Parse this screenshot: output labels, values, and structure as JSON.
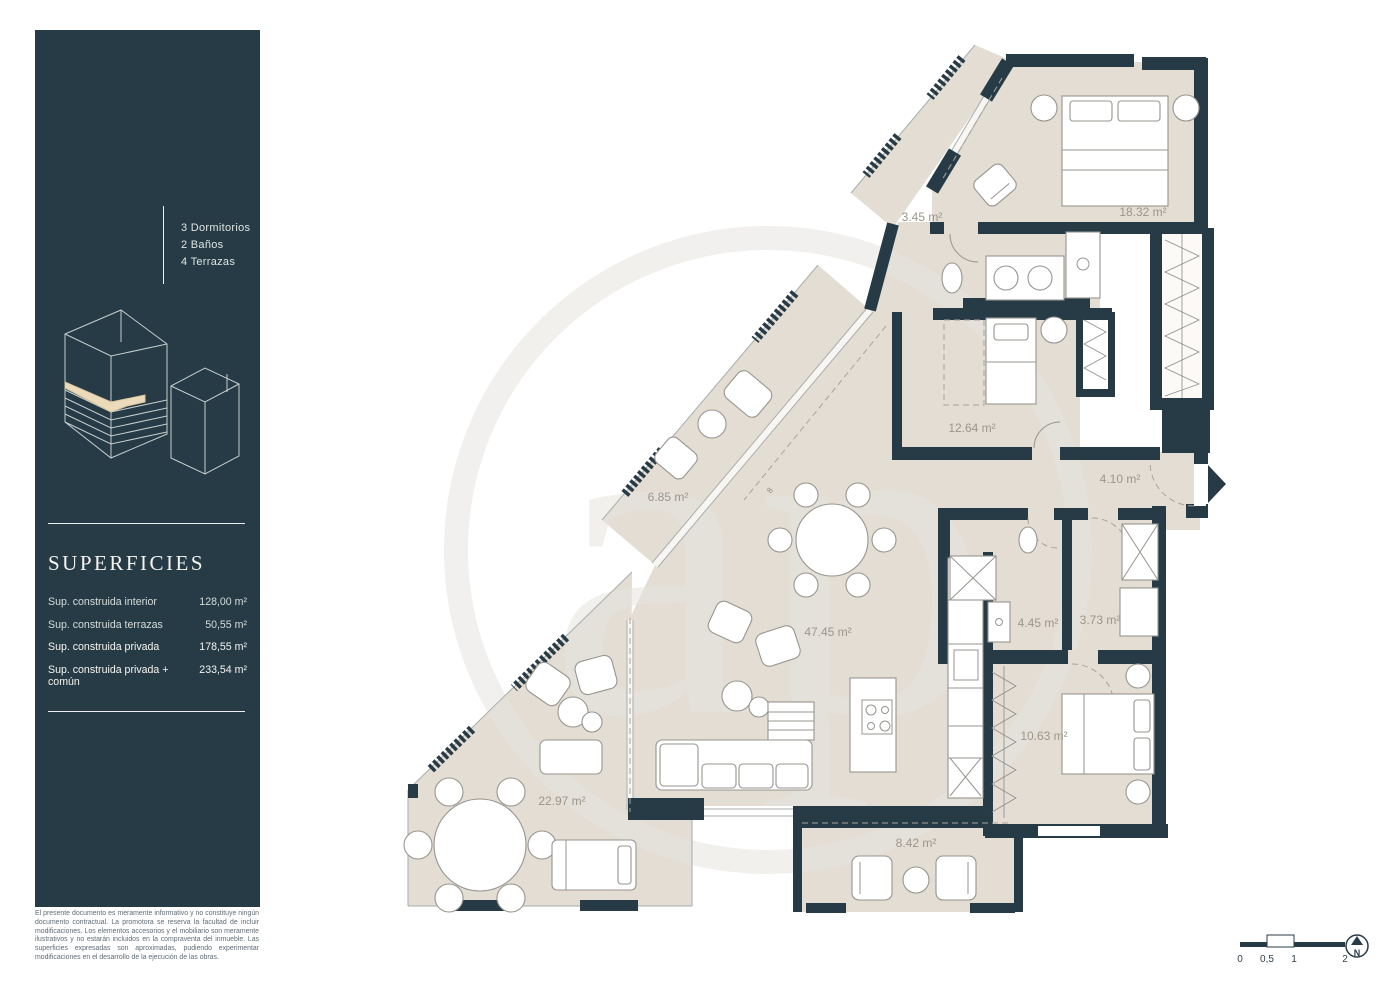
{
  "sidebar": {
    "program": [
      "3 Dormitorios",
      "2 Baños",
      "4 Terrazas"
    ],
    "superficies_title": "SUPERFICIES",
    "superficies": [
      {
        "label": "Sup. construida interior",
        "value": "128,00 m²"
      },
      {
        "label": "Sup. construida terrazas",
        "value": "50,55 m²"
      },
      {
        "label": "Sup. construida privada",
        "value": "178,55 m²"
      },
      {
        "label": "Sup. construida privada + común",
        "value": "233,54 m²"
      }
    ],
    "disclaimer": "El presente documento es meramente informativo y no constituye ningún documento contractual. La promotora se reserva la facultad de incluir modificaciones. Los elementos accesorios y el mobiliario son meramente ilustrativos y no estarán incluidos en la compraventa del inmueble. Las superficies expresadas son aproximadas, pudiendo experimentar modificaciones en el desarrollo de la ejecución de las obras."
  },
  "plan": {
    "rooms": [
      {
        "area": "18.32 m²"
      },
      {
        "area": "3.45 m²"
      },
      {
        "area": "12.64 m²"
      },
      {
        "area": "4.10 m²"
      },
      {
        "area": "6.85 m²"
      },
      {
        "area": "47.45 m²"
      },
      {
        "area": "4.45 m²"
      },
      {
        "area": "3.73 m²"
      },
      {
        "area": "10.63 m²"
      },
      {
        "area": "22.97 m²"
      },
      {
        "area": "8.42 m²"
      }
    ],
    "dim_mark": "8",
    "watermark": "ap",
    "scale_ticks": [
      "0",
      "0,5",
      "1",
      "2"
    ],
    "north_label": "N"
  },
  "colors": {
    "panel": "#273b47",
    "wall": "#273b47",
    "floor": "#e3ddd3",
    "highlight_slab": "#ecdbba",
    "label": "#9c968a"
  }
}
